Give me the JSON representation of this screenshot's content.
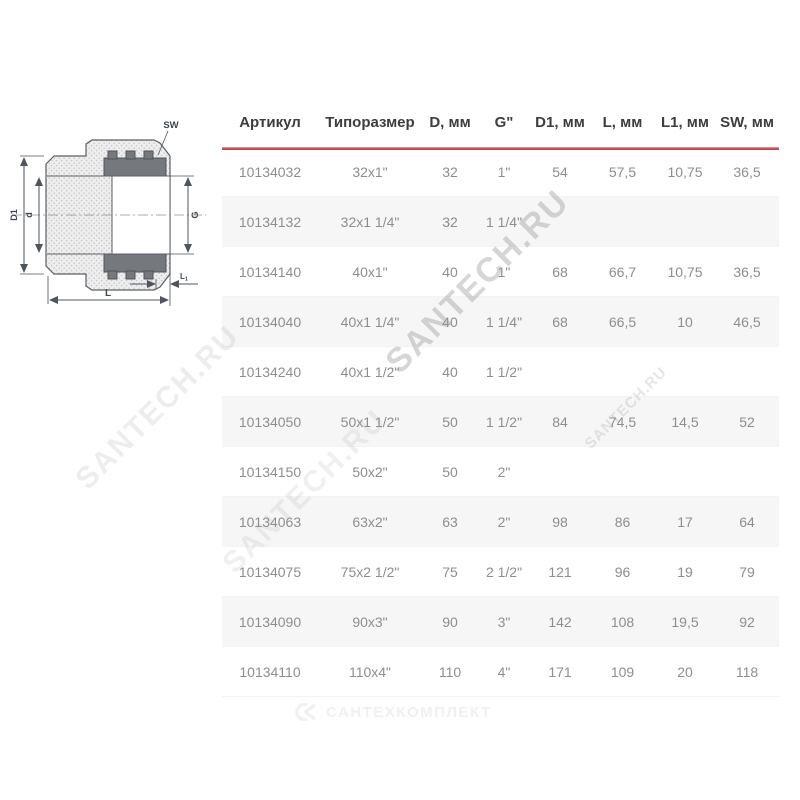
{
  "diagram": {
    "labels": {
      "d1": "D1",
      "d": "d",
      "g": "G",
      "sw": "SW",
      "l": "L",
      "l1": "L1"
    }
  },
  "watermark": {
    "text": "SANTECH.RU"
  },
  "footer": {
    "logo_icon": "ck-monogram-icon",
    "logo_text": "САНТЕХКОМПЛЕКТ"
  },
  "table": {
    "headers": [
      "Артикул",
      "Типоразмер",
      "D, мм",
      "G\"",
      "D1, мм",
      "L, мм",
      "L1, мм",
      "SW, мм"
    ],
    "rows": [
      [
        "10134032",
        "32x1\"",
        "32",
        "1\"",
        "54",
        "57,5",
        "10,75",
        "36,5"
      ],
      [
        "10134132",
        "32x1 1/4\"",
        "32",
        "1 1/4\"",
        "",
        "",
        "",
        ""
      ],
      [
        "10134140",
        "40x1\"",
        "40",
        "1\"",
        "68",
        "66,7",
        "10,75",
        "36,5"
      ],
      [
        "10134040",
        "40x1 1/4\"",
        "40",
        "1 1/4\"",
        "68",
        "66,5",
        "10",
        "46,5"
      ],
      [
        "10134240",
        "40x1 1/2\"",
        "40",
        "1 1/2\"",
        "",
        "",
        "",
        ""
      ],
      [
        "10134050",
        "50x1 1/2\"",
        "50",
        "1 1/2\"",
        "84",
        "74,5",
        "14,5",
        "52"
      ],
      [
        "10134150",
        "50x2\"",
        "50",
        "2\"",
        "",
        "",
        "",
        ""
      ],
      [
        "10134063",
        "63x2\"",
        "63",
        "2\"",
        "98",
        "86",
        "17",
        "64"
      ],
      [
        "10134075",
        "75x2 1/2\"",
        "75",
        "2 1/2\"",
        "121",
        "96",
        "19",
        "79"
      ],
      [
        "10134090",
        "90x3\"",
        "90",
        "3\"",
        "142",
        "108",
        "19,5",
        "92"
      ],
      [
        "10134110",
        "110x4\"",
        "110",
        "4\"",
        "171",
        "109",
        "20",
        "118"
      ]
    ]
  },
  "colors": {
    "accent_red": "#c24950",
    "stripe": "#f6f6f6",
    "header_text": "#3d3d3d",
    "cell_text": "#8e8e8e",
    "watermark_gray": "#9a9a9a"
  }
}
